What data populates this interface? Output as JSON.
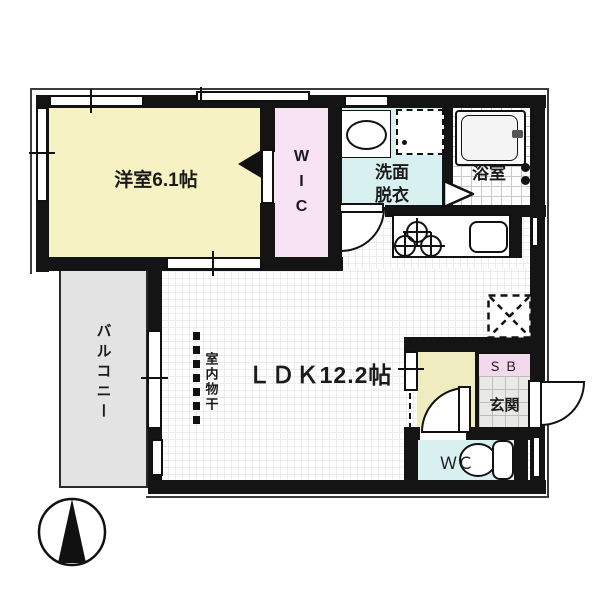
{
  "plan": {
    "bedroom_label": "洋室6.1帖",
    "wic_label": "WIC",
    "washroom_label_1": "洗面",
    "washroom_label_2": "脱衣",
    "bathroom_label": "浴室",
    "ldk_label": "ＬＤＫ12.2帖",
    "indoor_drying_label": "室内物干",
    "balcony_label": "バルコニー",
    "shoebox_label": "ＳＢ",
    "entrance_label": "玄関",
    "wc_label": "ＷＣ"
  },
  "colors": {
    "wall": "#141414",
    "bedroom": "#f6f2c3",
    "wic": "#f8e3f4",
    "washroom": "#d9f0f1",
    "wc": "#d9f0f1",
    "hall": "#efecc0",
    "shoebox": "#f3d9ec",
    "balcony": "#e3e3e3",
    "entrance_tile": "#e9e9e6"
  }
}
